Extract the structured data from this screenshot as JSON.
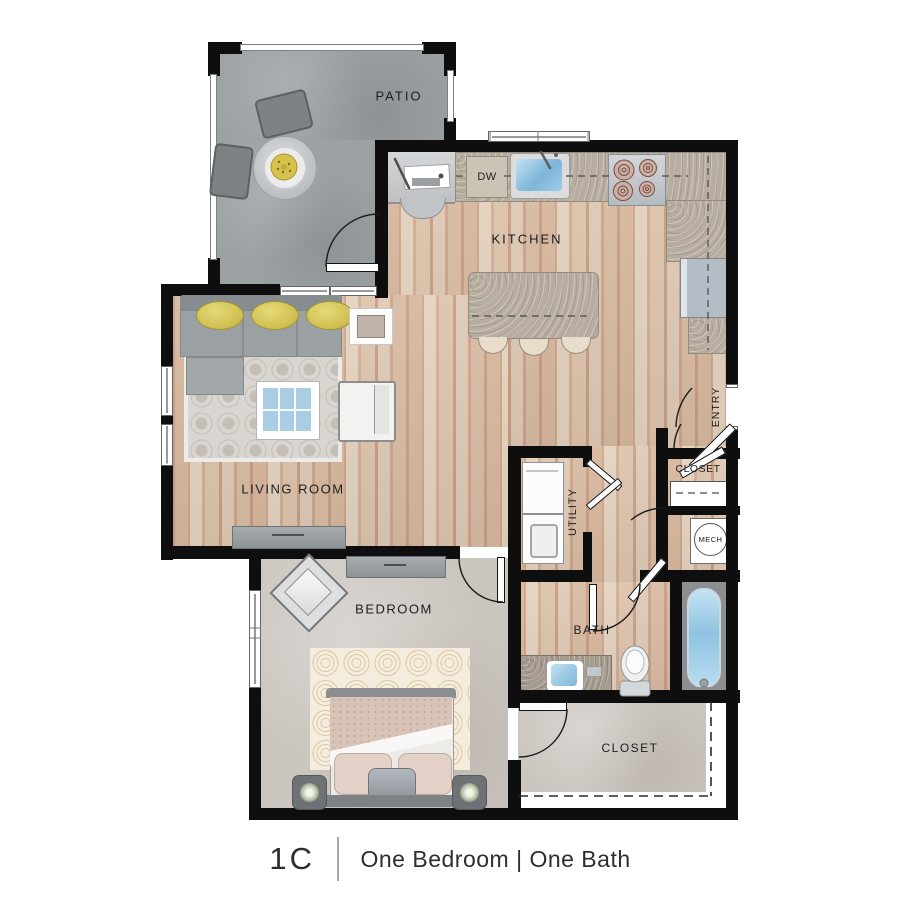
{
  "plan": {
    "labels": {
      "patio": "PATIO",
      "kitchen": "KITCHEN",
      "living_room": "LIVING ROOM",
      "bedroom": "BEDROOM",
      "bath": "BATH",
      "utility": "UTILITY",
      "entry": "ENTRY",
      "entry_closet": "CLOSET",
      "mech": "MECH",
      "walkin_closet": "CLOSET",
      "dishwasher": "DW"
    },
    "colors": {
      "wall": "#0e0e0e",
      "wood_floor": "#d6b7a0",
      "patio_floor": "#9ca1a4",
      "carpet": "#cbc5bf",
      "counter": "#b7aea0",
      "water_blue": "#8cc4e2",
      "pillow_yellow": "#d5c55c",
      "living_rug": "#d9d5d0",
      "bedroom_rug": "#f4edde",
      "background": "#ffffff"
    }
  },
  "caption": {
    "unit": "1C",
    "description": "One Bedroom | One Bath"
  }
}
